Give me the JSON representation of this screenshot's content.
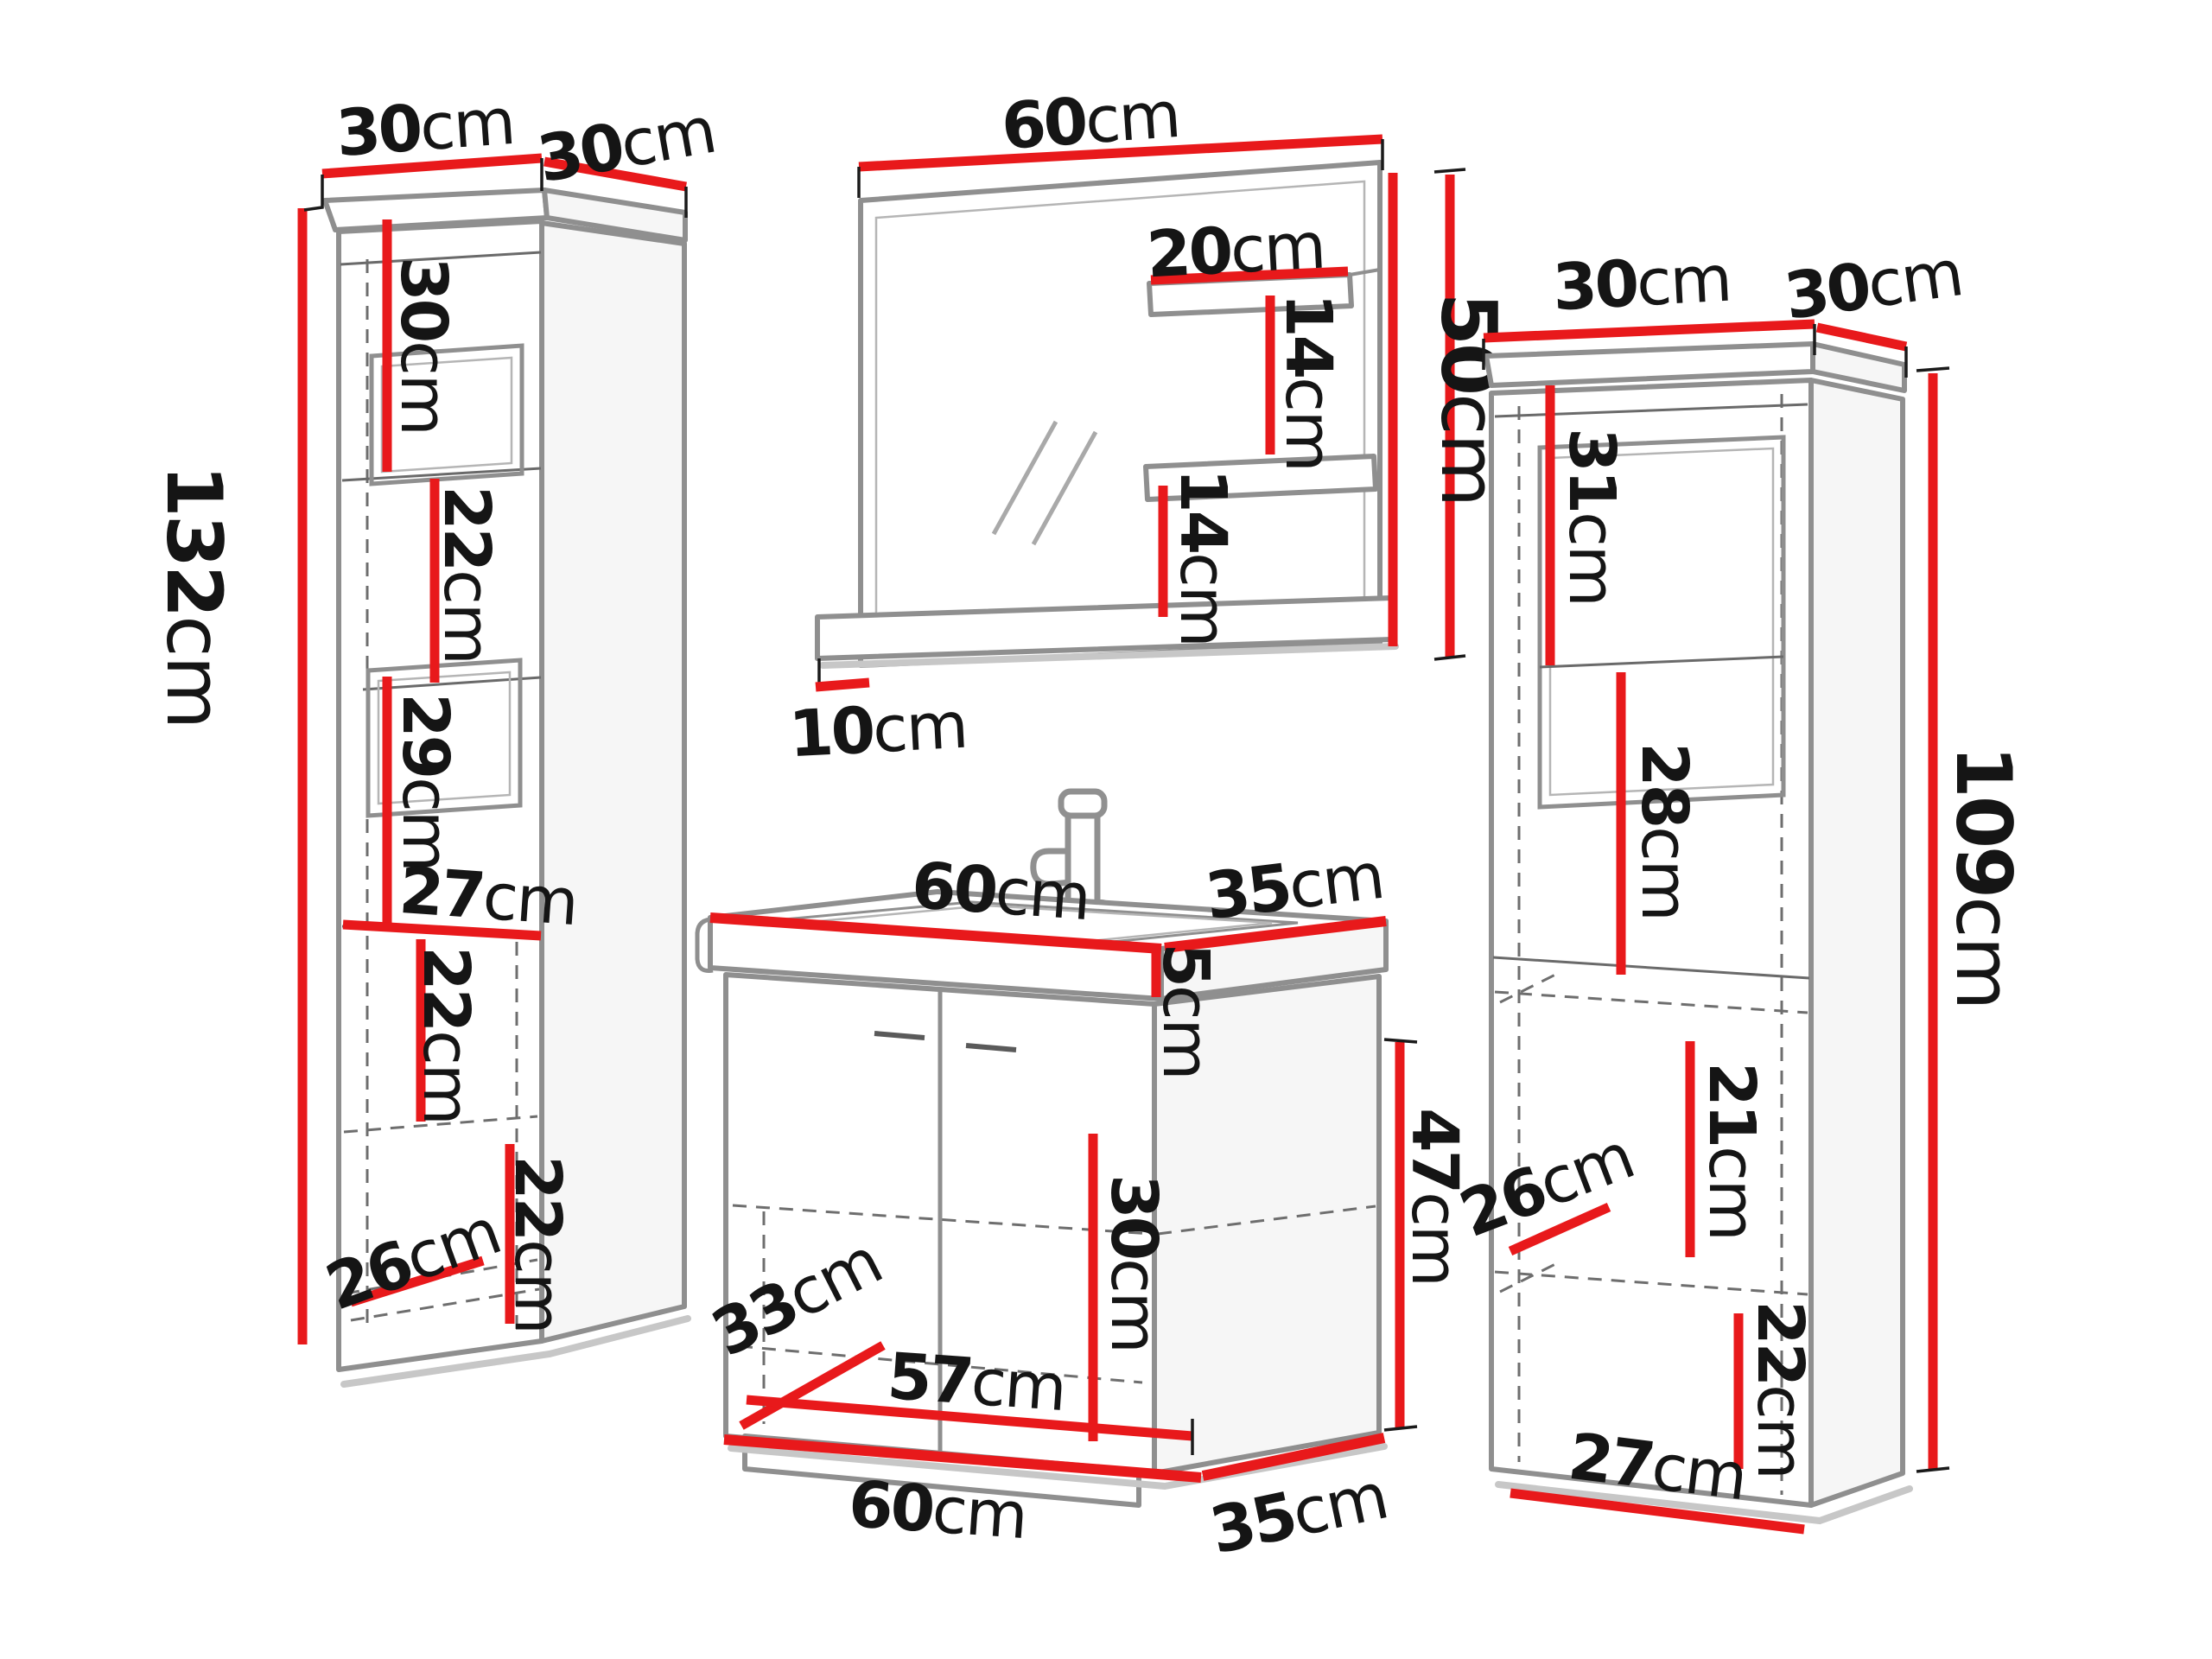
{
  "diagram": "bathroom-furniture-dimension-diagram",
  "colors": {
    "dimension_line": "#e8191b",
    "outline": "#8f8f8f",
    "text": "#151515",
    "background": "#ffffff"
  },
  "pieces": {
    "left_cabinet": {
      "name": "tall cabinet",
      "dims": {
        "top_width": {
          "value": "30",
          "unit": "cm"
        },
        "top_depth": {
          "value": "30",
          "unit": "cm"
        },
        "height": {
          "value": "132",
          "unit": "cm"
        },
        "section_1": {
          "value": "30",
          "unit": "cm"
        },
        "section_2": {
          "value": "22",
          "unit": "cm"
        },
        "section_3": {
          "value": "29",
          "unit": "cm"
        },
        "inner_width": {
          "value": "27",
          "unit": "cm"
        },
        "section_4": {
          "value": "22",
          "unit": "cm"
        },
        "section_5": {
          "value": "22",
          "unit": "cm"
        },
        "inner_depth": {
          "value": "26",
          "unit": "cm"
        }
      }
    },
    "mirror": {
      "name": "mirror with shelves",
      "dims": {
        "width": {
          "value": "60",
          "unit": "cm"
        },
        "shelf_width": {
          "value": "20",
          "unit": "cm"
        },
        "shelf_gap_1": {
          "value": "14",
          "unit": "cm"
        },
        "shelf_gap_2": {
          "value": "14",
          "unit": "cm"
        },
        "height": {
          "value": "50",
          "unit": "cm"
        },
        "ledge_depth": {
          "value": "10",
          "unit": "cm"
        }
      }
    },
    "vanity": {
      "name": "sink vanity cabinet",
      "dims": {
        "top_width": {
          "value": "60",
          "unit": "cm"
        },
        "top_depth": {
          "value": "35",
          "unit": "cm"
        },
        "basin_height": {
          "value": "5",
          "unit": "cm"
        },
        "body_height": {
          "value": "47",
          "unit": "cm"
        },
        "inner_height": {
          "value": "30",
          "unit": "cm"
        },
        "inner_depth": {
          "value": "33",
          "unit": "cm"
        },
        "inner_width": {
          "value": "57",
          "unit": "cm"
        },
        "bottom_width": {
          "value": "60",
          "unit": "cm"
        },
        "bottom_depth": {
          "value": "35",
          "unit": "cm"
        }
      }
    },
    "right_cabinet": {
      "name": "tall cabinet",
      "dims": {
        "top_width": {
          "value": "30",
          "unit": "cm"
        },
        "top_depth": {
          "value": "30",
          "unit": "cm"
        },
        "section_1": {
          "value": "31",
          "unit": "cm"
        },
        "section_2": {
          "value": "28",
          "unit": "cm"
        },
        "height": {
          "value": "109",
          "unit": "cm"
        },
        "section_3": {
          "value": "21",
          "unit": "cm"
        },
        "inner_depth": {
          "value": "26",
          "unit": "cm"
        },
        "section_4": {
          "value": "22",
          "unit": "cm"
        },
        "bottom_width": {
          "value": "27",
          "unit": "cm"
        }
      }
    }
  }
}
